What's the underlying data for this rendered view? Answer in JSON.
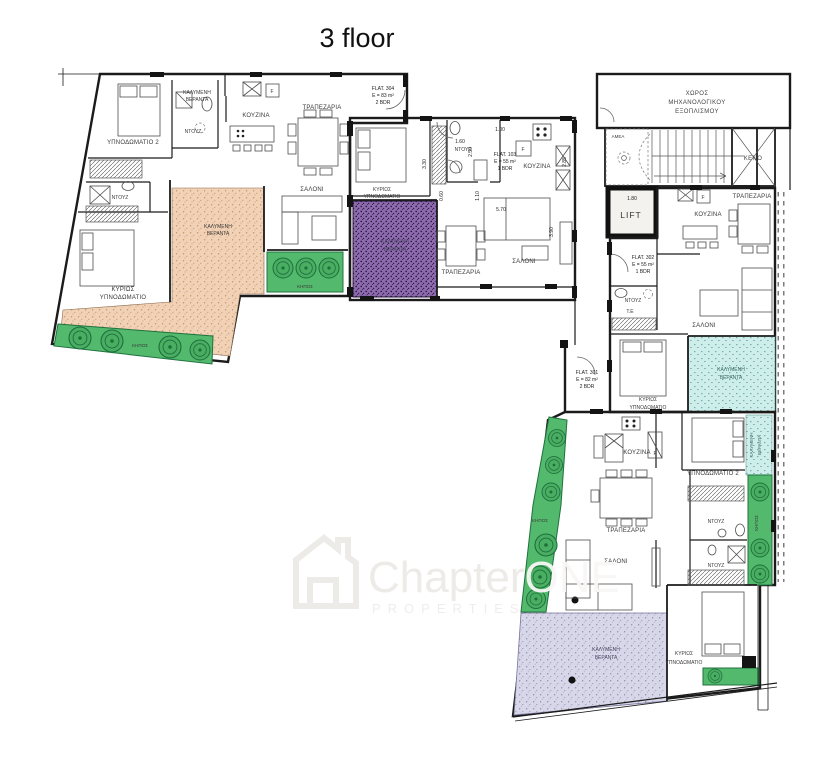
{
  "title": "3 floor",
  "watermark": {
    "brand_1": "Chapter",
    "brand_2": "ONE",
    "subtitle": "PROPERTIES"
  },
  "rooms": {
    "kitchen": "ΚΟΥΖΙΝΑ",
    "dining": "ΤΡΑΠΕΖΑΡΙΑ",
    "living": "ΣΑΛΟΝΙ",
    "shower": "ΝΤΟΥΖ",
    "wc": "Τ.Ε",
    "master_1": "ΚΥΡΙΩΣ",
    "master_2": "ΥΠΝΟΔΩΜΑΤΙΟ",
    "bedroom2": "ΥΠΝΟΔΩΜΑΤΙΟ 2",
    "veranda_1": "ΚΑΛΥΜΕΝΗ",
    "veranda_2": "ΒΕΡΑΝΤΑ",
    "garden": "ΚΗΠΟΣ",
    "fridge": "F"
  },
  "flats": {
    "f304": {
      "name": "FLAT. 304",
      "area": "E = 83 m²",
      "beds": "2 BDR"
    },
    "f103": {
      "name": "FLAT. 103",
      "area": "E = 55 m²",
      "beds": "1 BDR"
    },
    "f302": {
      "name": "FLAT. 302",
      "area": "E = 55 m²",
      "beds": "1 BDR"
    },
    "f301": {
      "name": "FLAT. 301",
      "area": "E = 82 m²",
      "beds": "2 BDR"
    }
  },
  "core": {
    "mech_1": "ΧΩΡΟΣ",
    "mech_2": "ΜΗΧΑΝΟΛΟΓΙΚΟΥ",
    "mech_3": "ΕΞΟΠΛΙΣΜΟΥ",
    "void": "ΚΕΝΟ",
    "lift": "LIFT",
    "accessible": "ΑΜΕΑ"
  },
  "dims": {
    "lift_w": "1.80",
    "d330": "3.30",
    "d160": "1.60",
    "d250": "2.50",
    "d100": "1.00",
    "d285": "2.85",
    "d060": "0.60",
    "d110": "1.10",
    "d570": "5.70",
    "d390": "3.90"
  },
  "colors": {
    "peach": "#f7dcc3",
    "purple": "#c9abdd",
    "purple_veranda": "#8d6bae",
    "teal": "#ccf2ed",
    "lavender": "#d9d8ea",
    "green": "#53b96c",
    "core_gray": "#f1efec"
  }
}
